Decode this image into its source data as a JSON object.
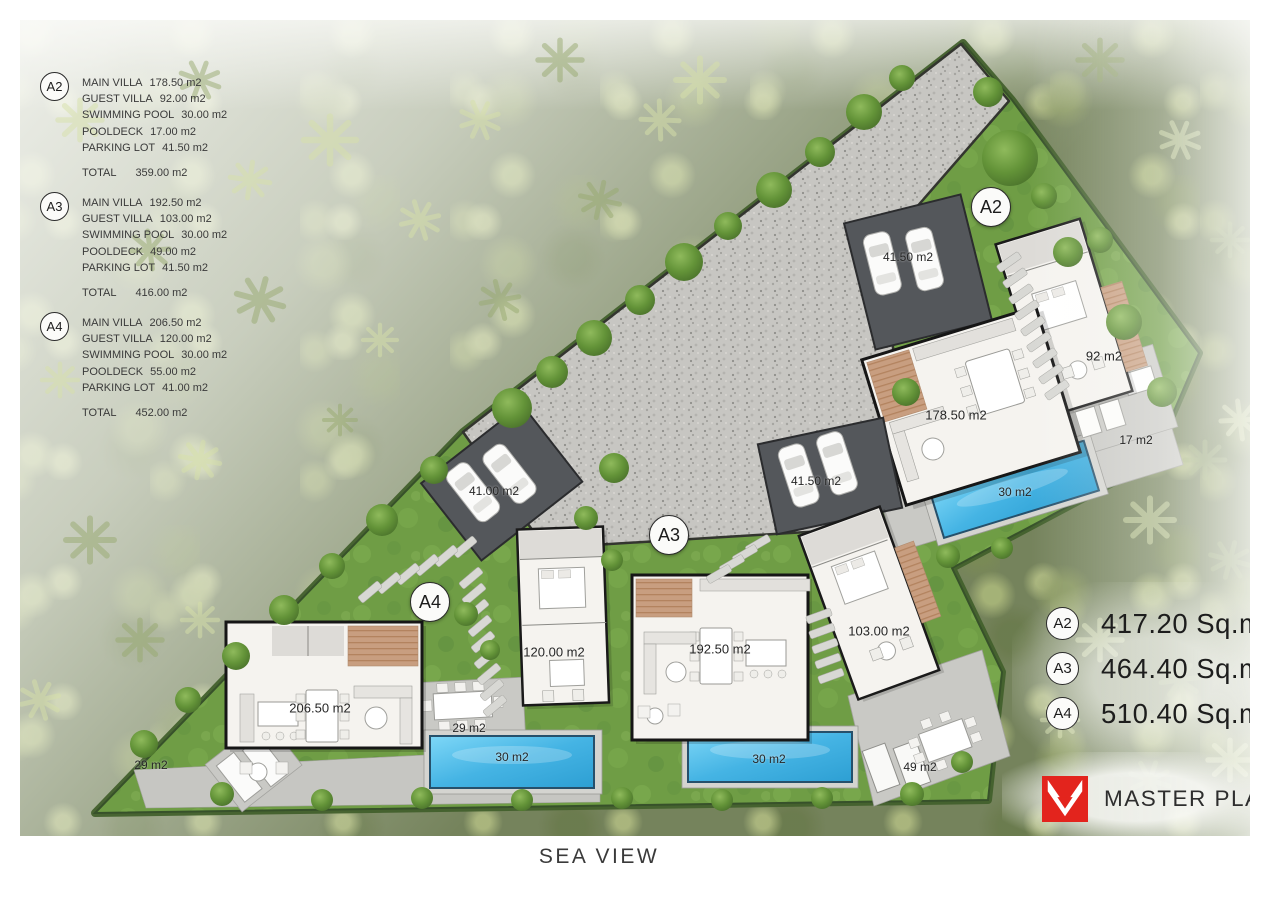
{
  "legend": {
    "blocks": [
      {
        "badge": "A2",
        "items": [
          {
            "label": "MAIN VILLA",
            "value": "178.50 m2"
          },
          {
            "label": "GUEST VILLA",
            "value": "92.00 m2"
          },
          {
            "label": "SWIMMING POOL",
            "value": "30.00 m2"
          },
          {
            "label": "POOLDECK",
            "value": "17.00 m2"
          },
          {
            "label": "PARKING LOT",
            "value": "41.50 m2"
          }
        ],
        "total_label": "TOTAL",
        "total_value": "359.00 m2"
      },
      {
        "badge": "A3",
        "items": [
          {
            "label": "MAIN VILLA",
            "value": "192.50 m2"
          },
          {
            "label": "GUEST VILLA",
            "value": "103.00 m2"
          },
          {
            "label": "SWIMMING POOL",
            "value": "30.00 m2"
          },
          {
            "label": "POOLDECK",
            "value": "49.00 m2"
          },
          {
            "label": "PARKING LOT",
            "value": "41.50 m2"
          }
        ],
        "total_label": "TOTAL",
        "total_value": "416.00 m2"
      },
      {
        "badge": "A4",
        "items": [
          {
            "label": "MAIN VILLA",
            "value": "206.50 m2"
          },
          {
            "label": "GUEST VILLA",
            "value": "120.00 m2"
          },
          {
            "label": "SWIMMING POOL",
            "value": "30.00 m2"
          },
          {
            "label": "POOLDECK",
            "value": "55.00 m2"
          },
          {
            "label": "PARKING LOT",
            "value": "41.00 m2"
          }
        ],
        "total_label": "TOTAL",
        "total_value": "452.00 m2"
      }
    ]
  },
  "summary": {
    "rows": [
      {
        "badge": "A2",
        "area": "417.20 Sq.m"
      },
      {
        "badge": "A3",
        "area": "464.40 Sq.m"
      },
      {
        "badge": "A4",
        "area": "510.40 Sq.m"
      }
    ]
  },
  "plan": {
    "badges": {
      "a2": "A2",
      "a3": "A3",
      "a4": "A4"
    },
    "labels": {
      "a2_parking": "41.50 m2",
      "a2_guest": "92 m2",
      "a2_main": "178.50 m2",
      "a2_pooldeck": "17 m2",
      "a2_pool": "30 m2",
      "a3_parking": "41.50 m2",
      "a3_guest": "103.00 m2",
      "a3_main": "192.50 m2",
      "a3_pool": "30 m2",
      "a3_deck": "49 m2",
      "a4_parking": "41.00 m2",
      "a4_guest": "120.00 m2",
      "a4_main": "206.50 m2",
      "a4_deck_left": "29 m2",
      "a4_deck_right": "29 m2",
      "a4_pool": "30 m2"
    }
  },
  "footer": {
    "sea_view": "SEA VIEW"
  },
  "branding": {
    "logo_label": "MASTER PLAN"
  },
  "colors": {
    "accent_red": "#e3241d",
    "pool_blue": "#45b4e4",
    "lawn_green": "#6f9d45",
    "gravel_gray": "#c7c6c2"
  }
}
